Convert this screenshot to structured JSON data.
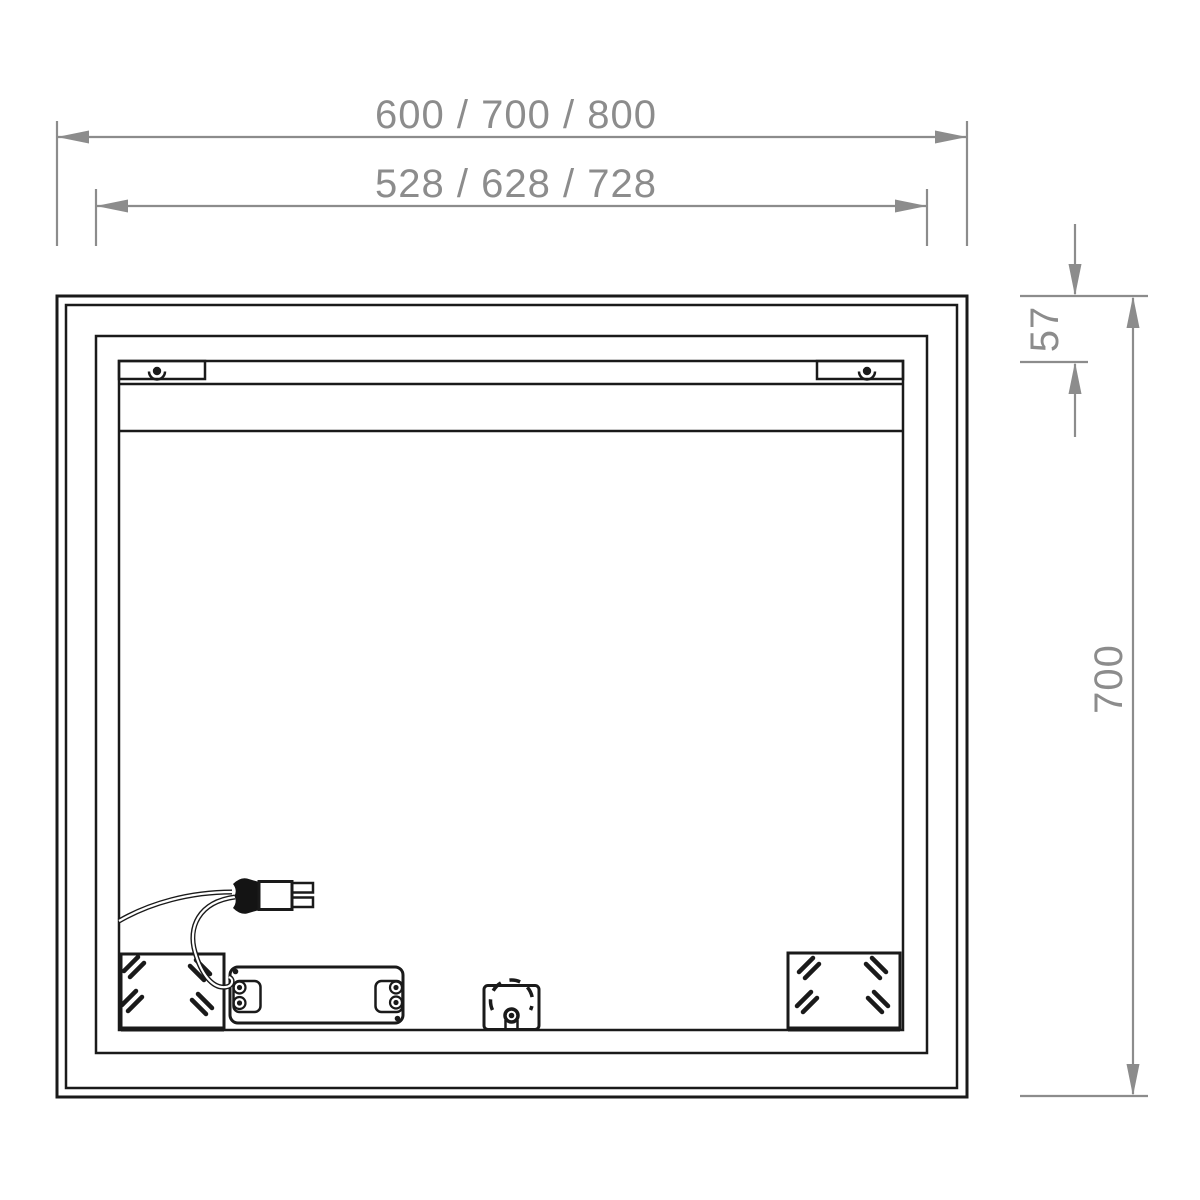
{
  "drawing": {
    "type": "technical-dimension-drawing",
    "subject": "illuminated-mirror-rear-view",
    "dimension_labels": {
      "overall_width": "600 / 700 / 800",
      "hanger_width": "528 / 628 / 728",
      "rail_offset_top": "57",
      "overall_height": "700"
    },
    "colors": {
      "outline": "#1a1a1a",
      "dimension": "#8c8c8c",
      "background": "#ffffff"
    }
  }
}
